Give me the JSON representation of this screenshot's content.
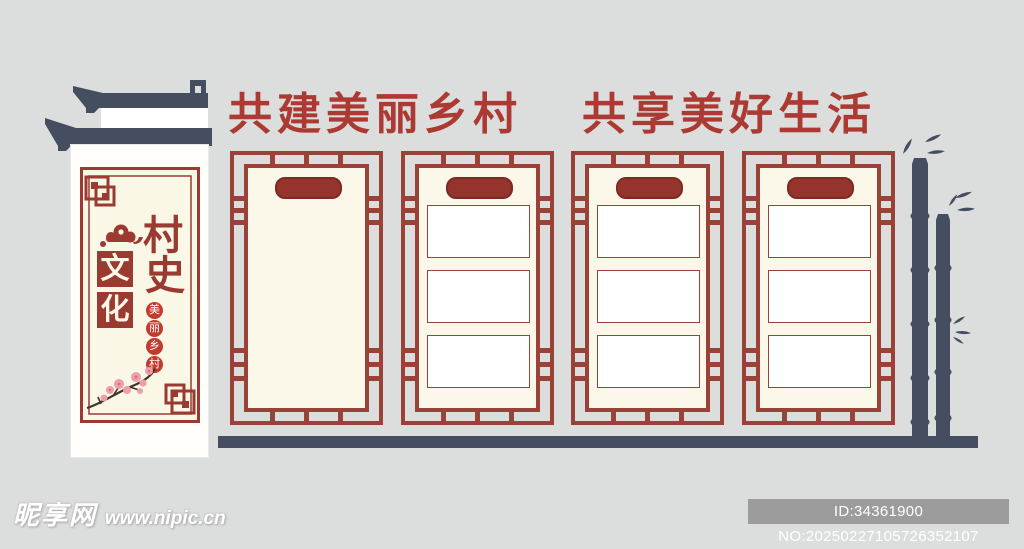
{
  "meta": {
    "background_color": "#dcdddd",
    "theme": "village history culture wall design"
  },
  "banner": {
    "phrase_1": "共建美丽乡村",
    "phrase_2": "共享美好生活",
    "color": "#ac3a33"
  },
  "sign": {
    "title_chars": [
      "村",
      "史"
    ],
    "block_chars": [
      "文",
      "化"
    ],
    "badge_chars": [
      "美",
      "丽",
      "乡",
      "村"
    ],
    "frame_color": "#9a3a31",
    "panel_color": "#fffefa",
    "roof_color": "#454e61",
    "decorations": [
      "roof-eaves",
      "auspicious-cloud",
      "plum-blossom",
      "lattice-knot-frame"
    ]
  },
  "display_panels": {
    "count": 4,
    "frame_color": "#9a4238",
    "panel_fill": "#fcf8e9",
    "plaque_color": "#95342c",
    "panels": [
      {
        "name": "panel-1",
        "plaque": true,
        "content_boxes": 0
      },
      {
        "name": "panel-2",
        "plaque": true,
        "content_boxes": 3
      },
      {
        "name": "panel-3",
        "plaque": true,
        "content_boxes": 3
      },
      {
        "name": "panel-4",
        "plaque": true,
        "content_boxes": 3
      }
    ]
  },
  "scenery": {
    "bamboo_stalks": 2,
    "color": "#454e61"
  },
  "watermark": {
    "site_name": "昵享网",
    "site_url": "www.nipic.cn"
  },
  "footer_badge": {
    "text": "ID:34361900 NO:20250227105726352107",
    "background": "#9c9c9c"
  }
}
